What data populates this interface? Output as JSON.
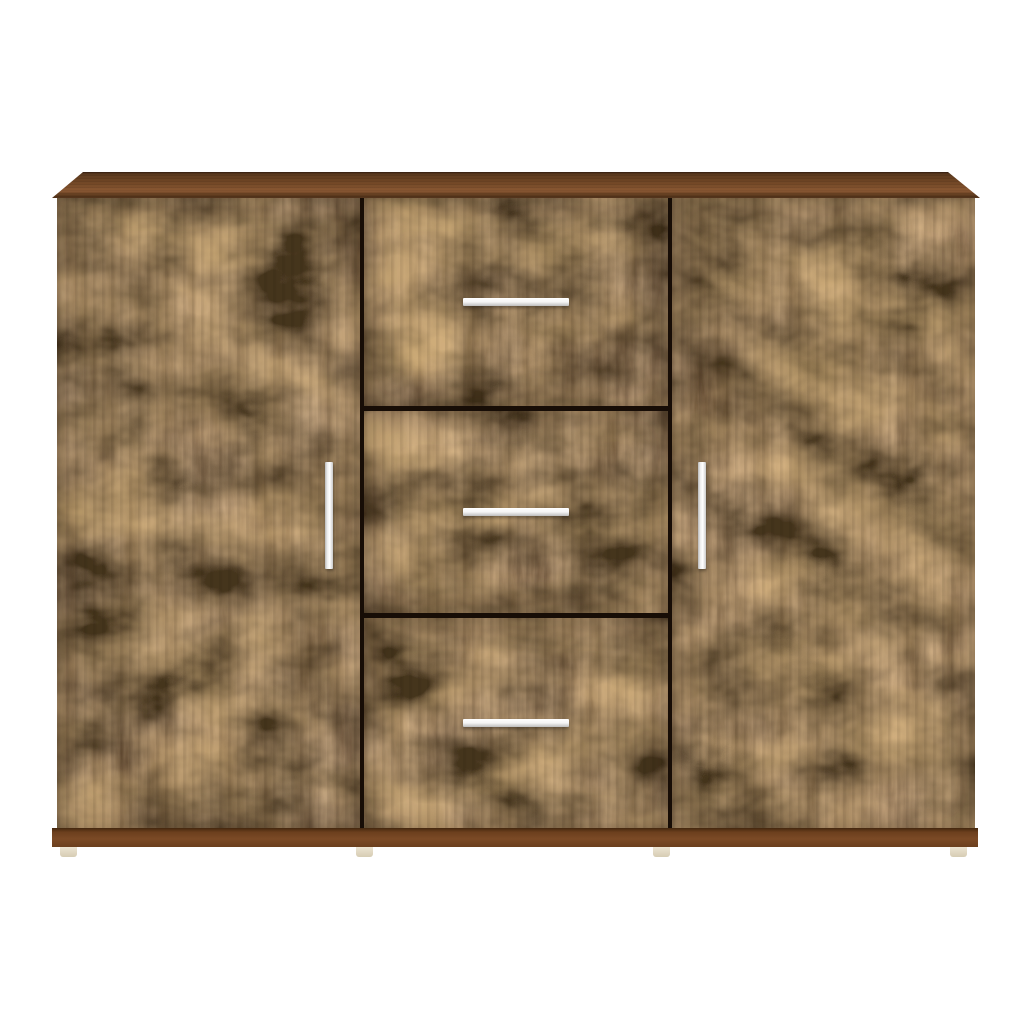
{
  "meta": {
    "description": "Product photo of a wooden sideboard cabinet in a dark smoked-oak grain finish standing on a plain white background. It has a slightly overhanging top panel, a left door and a right door each with a vertical silver bar handle, a central stack of three drawers each with a horizontal silver bar handle, a solid brown plinth and four small cream feet."
  },
  "product": {
    "item": "sideboard-cabinet",
    "finish": "smoked-oak wood grain",
    "door_count": 2,
    "drawer_count": 3,
    "foot_count": 4,
    "handle_style": "silver bar",
    "door_handle_orientation": "vertical",
    "drawer_handle_orientation": "horizontal"
  },
  "colors": {
    "background": "#ffffff",
    "gap": "#170d06",
    "wood_mid": "#6e4524",
    "top_edge_dark": "#3a2212",
    "top_face": "#6f4524",
    "top_face_light": "#8a5732",
    "top_face_shadow": "#4e2f18",
    "plinth": "#7b4a26",
    "plinth_dark": "#43270f",
    "foot": "#ece4d1",
    "foot_shadow": "#d6ccb3",
    "handle": "#f4f4f4",
    "handle_edge": "#b9b9b9",
    "handle_shadow": "rgba(0,0,0,0.35)"
  }
}
